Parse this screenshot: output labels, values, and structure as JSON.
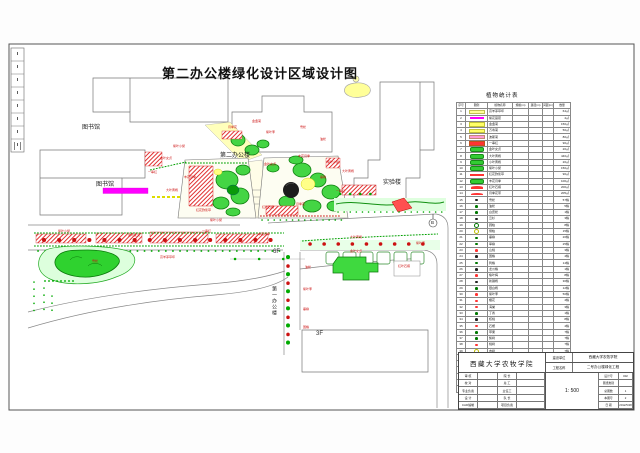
{
  "sheet": {
    "title": "第二办公楼绿化设计区域设计图"
  },
  "plan": {
    "building_labels": [
      {
        "text": "图书馆",
        "x": 82,
        "y": 122
      },
      {
        "text": "图书馆",
        "x": 96,
        "y": 179
      },
      {
        "text": "第二办公楼",
        "x": 220,
        "y": 150
      },
      {
        "text": "实验楼",
        "x": 383,
        "y": 177
      }
    ],
    "floor_labels": [
      {
        "text": "6F",
        "x": 273,
        "y": 249
      },
      {
        "text": "3F",
        "x": 316,
        "y": 331
      }
    ],
    "road_label": "第一办公楼",
    "section_marker": "B",
    "annotations": [
      {
        "text": "紫叶小檗",
        "x": 173,
        "y": 145
      },
      {
        "text": "金叶女贞",
        "x": 160,
        "y": 157
      },
      {
        "text": "丰花月季",
        "x": 184,
        "y": 176
      },
      {
        "text": "大叶黄杨",
        "x": 166,
        "y": 189
      },
      {
        "text": "红花酢浆草",
        "x": 196,
        "y": 209
      },
      {
        "text": "一串红",
        "x": 148,
        "y": 171
      },
      {
        "text": "月季花",
        "x": 228,
        "y": 126
      },
      {
        "text": "金盏菊",
        "x": 252,
        "y": 120
      },
      {
        "text": "紫叶李",
        "x": 266,
        "y": 131
      },
      {
        "text": "雪松",
        "x": 300,
        "y": 126
      },
      {
        "text": "油松",
        "x": 320,
        "y": 138
      },
      {
        "text": "金叶女贞",
        "x": 264,
        "y": 163
      },
      {
        "text": "丰花月季",
        "x": 298,
        "y": 155
      },
      {
        "text": "紫叶小檗",
        "x": 327,
        "y": 161
      },
      {
        "text": "大叶黄杨",
        "x": 342,
        "y": 170
      },
      {
        "text": "垂柳",
        "x": 320,
        "y": 176
      },
      {
        "text": "一串红",
        "x": 336,
        "y": 190
      },
      {
        "text": "月季花",
        "x": 296,
        "y": 203
      },
      {
        "text": "红叶石楠",
        "x": 262,
        "y": 206
      },
      {
        "text": "紫叶小檗",
        "x": 58,
        "y": 230
      },
      {
        "text": "金叶女贞",
        "x": 128,
        "y": 234
      },
      {
        "text": "一串红",
        "x": 202,
        "y": 230
      },
      {
        "text": "丰花月季",
        "x": 258,
        "y": 233
      },
      {
        "text": "大叶黄杨",
        "x": 350,
        "y": 236
      },
      {
        "text": "紫叶李",
        "x": 416,
        "y": 242
      },
      {
        "text": "高羊茅草坪",
        "x": 160,
        "y": 256
      },
      {
        "text": "金叶女贞",
        "x": 350,
        "y": 250
      },
      {
        "text": "雪松",
        "x": 92,
        "y": 260
      },
      {
        "text": "油松",
        "x": 305,
        "y": 266
      },
      {
        "text": "紫叶李",
        "x": 303,
        "y": 288
      },
      {
        "text": "垂柳",
        "x": 303,
        "y": 308
      },
      {
        "text": "国槐",
        "x": 303,
        "y": 326
      },
      {
        "text": "红叶石楠",
        "x": 398,
        "y": 265
      },
      {
        "text": "紫叶小檗",
        "x": 210,
        "y": 219
      }
    ]
  },
  "legend_table": {
    "title": "植物统计表",
    "headers": [
      "序号",
      "图例",
      "植物名称",
      "规格(m)",
      "蓬径(m)",
      "间距(m)",
      "数量"
    ],
    "rows": [
      {
        "no": "1",
        "name": "高羊茅草坪",
        "qty": "64㎡",
        "sym": "patch",
        "color": "#ffff99"
      },
      {
        "no": "2",
        "name": "紫花苜蓿",
        "qty": "4㎡",
        "sym": "stripe",
        "color": "#ff00ff"
      },
      {
        "no": "3",
        "name": "金盏菊",
        "qty": "150㎡",
        "sym": "patch",
        "color": "#ffff66"
      },
      {
        "no": "4",
        "name": "万寿菊",
        "qty": "50㎡",
        "sym": "patch",
        "color": "#ffff66"
      },
      {
        "no": "5",
        "name": "波斯菊",
        "qty": "80㎡",
        "sym": "patch",
        "color": "#ff9ad5"
      },
      {
        "no": "6",
        "name": "一串红",
        "qty": "90㎡",
        "sym": "patch",
        "color": "#ff3333"
      },
      {
        "no": "7",
        "name": "金叶女贞",
        "qty": "20㎡",
        "sym": "blob",
        "color": "#33cc33"
      },
      {
        "no": "8",
        "name": "大叶黄杨",
        "qty": "440㎡",
        "sym": "blob",
        "color": "#33cc33"
      },
      {
        "no": "9",
        "name": "小叶黄杨",
        "qty": "20㎡",
        "sym": "blob",
        "color": "#33cc33"
      },
      {
        "no": "10",
        "name": "紫叶小檗",
        "qty": "150㎡",
        "sym": "blob",
        "color": "#33cc33"
      },
      {
        "no": "11",
        "name": "红花酢浆草",
        "qty": "90㎡",
        "sym": "stripe",
        "color": "#ff3333"
      },
      {
        "no": "12",
        "name": "丰花月季",
        "qty": "100㎡",
        "sym": "blob",
        "color": "#33cc33"
      },
      {
        "no": "13",
        "name": "红叶石楠",
        "qty": "200㎡",
        "sym": "arc",
        "color": "#ff3333"
      },
      {
        "no": "14",
        "name": "月季花带",
        "qty": "205㎡",
        "sym": "arc",
        "color": "#ff3333"
      },
      {
        "no": "15",
        "name": "雪松",
        "qty": "57株",
        "sym": "dot",
        "color": "#222222"
      },
      {
        "no": "16",
        "name": "油松",
        "qty": "5株",
        "sym": "dot",
        "color": "#007700"
      },
      {
        "no": "17",
        "name": "白皮松",
        "qty": "1株",
        "sym": "dot",
        "color": "#007700"
      },
      {
        "no": "18",
        "name": "云杉",
        "qty": "3株",
        "sym": "dot",
        "color": "#222222"
      },
      {
        "no": "19",
        "name": "圆柏",
        "qty": "8株",
        "sym": "circ",
        "color": "#007700"
      },
      {
        "no": "20",
        "name": "侧柏",
        "qty": "15株",
        "sym": "circ",
        "color": "#bbbb00"
      },
      {
        "no": "21",
        "name": "垂柳",
        "qty": "20株",
        "sym": "dot",
        "color": "#007700"
      },
      {
        "no": "22",
        "name": "旱柳",
        "qty": "25株",
        "sym": "dot",
        "color": "#007700"
      },
      {
        "no": "23",
        "name": "山桃",
        "qty": "3株",
        "sym": "dot",
        "color": "#ff3333"
      },
      {
        "no": "24",
        "name": "国槐",
        "qty": "4株",
        "sym": "dot",
        "color": "#222222"
      },
      {
        "no": "25",
        "name": "刺槐",
        "qty": "14株",
        "sym": "dot",
        "color": "#007700"
      },
      {
        "no": "26",
        "name": "龙爪槐",
        "qty": "1株",
        "sym": "dot",
        "color": "#222222"
      },
      {
        "no": "27",
        "name": "榆叶梅",
        "qty": "8株",
        "sym": "dot",
        "color": "#ff3333"
      },
      {
        "no": "28",
        "name": "新疆杨",
        "qty": "30株",
        "sym": "dot",
        "color": "#222222"
      },
      {
        "no": "29",
        "name": "银白杨",
        "qty": "12株",
        "sym": "dot",
        "color": "#007700"
      },
      {
        "no": "30",
        "name": "紫叶李",
        "qty": "50株",
        "sym": "dot",
        "color": "#ff3333"
      },
      {
        "no": "31",
        "name": "樱花",
        "qty": "4株",
        "sym": "dot",
        "color": "#ff3333"
      },
      {
        "no": "32",
        "name": "海棠",
        "qty": "3株",
        "sym": "dot",
        "color": "#ff3333"
      },
      {
        "no": "33",
        "name": "丁香",
        "qty": "1株",
        "sym": "dot",
        "color": "#007700"
      },
      {
        "no": "34",
        "name": "核桃",
        "qty": "8株",
        "sym": "dot",
        "color": "#222222"
      },
      {
        "no": "35",
        "name": "石榴",
        "qty": "4株",
        "sym": "dot",
        "color": "#ff3333"
      },
      {
        "no": "36",
        "name": "苹果",
        "qty": "7株",
        "sym": "dot",
        "color": "#007700"
      },
      {
        "no": "37",
        "name": "梨树",
        "qty": "7株",
        "sym": "dot",
        "color": "#007700"
      },
      {
        "no": "38",
        "name": "桃树",
        "qty": "7株",
        "sym": "dot",
        "color": "#ff3333"
      },
      {
        "no": "39",
        "name": "杏树",
        "qty": "7株",
        "sym": "circ",
        "color": "#bbbb00"
      },
      {
        "no": "40",
        "name": "合欢",
        "qty": "7株",
        "sym": "dot",
        "color": "#007700"
      },
      {
        "no": "41",
        "name": "广玉兰",
        "qty": "1株",
        "sym": "circ",
        "color": "#888888"
      },
      {
        "no": "42",
        "name": "白蜡",
        "qty": "5株",
        "sym": "dot",
        "color": "#222222"
      },
      {
        "no": "43",
        "name": "复叶槭",
        "qty": "3株",
        "sym": "dot",
        "color": "#007700"
      },
      {
        "no": "44",
        "name": "杜梨",
        "qty": "7株",
        "sym": "dot",
        "color": "#222222"
      },
      {
        "no": "45",
        "name": "柽柳",
        "qty": "6株",
        "sym": "dot",
        "color": "#007700"
      }
    ]
  },
  "title_block": {
    "org": "西藏大学农牧学院",
    "fields_left": [
      [
        "审 核",
        ""
      ],
      [
        "校 对",
        ""
      ],
      [
        "专业负责",
        ""
      ],
      [
        "设 计",
        ""
      ],
      [
        "CAD编制",
        ""
      ]
    ],
    "fields_mid": [
      [
        "院 长",
        ""
      ],
      [
        "总 工",
        ""
      ],
      [
        "主任工",
        ""
      ],
      [
        "队 长",
        ""
      ],
      [
        "项目负责",
        ""
      ]
    ],
    "builder_label": "建设单位",
    "builder": "西藏大学农牧学院",
    "project_label": "工程名称",
    "project": "二号办公楼绿化工程",
    "scale": "1: 500",
    "fields_right": [
      [
        "设计号",
        "002"
      ],
      [
        "图纸类别",
        ""
      ],
      [
        "总图数",
        "1"
      ],
      [
        "本图号",
        "2"
      ],
      [
        "日 期",
        "2012/5/28"
      ]
    ]
  },
  "colors": {
    "annotation_red": "#cc1111",
    "shrub_green": "#44d544",
    "hedge_green": "#00a000",
    "flowerbed_red": "#e03030",
    "path_yellow": "#ffffbb",
    "strip_magenta": "#ff00ff"
  }
}
